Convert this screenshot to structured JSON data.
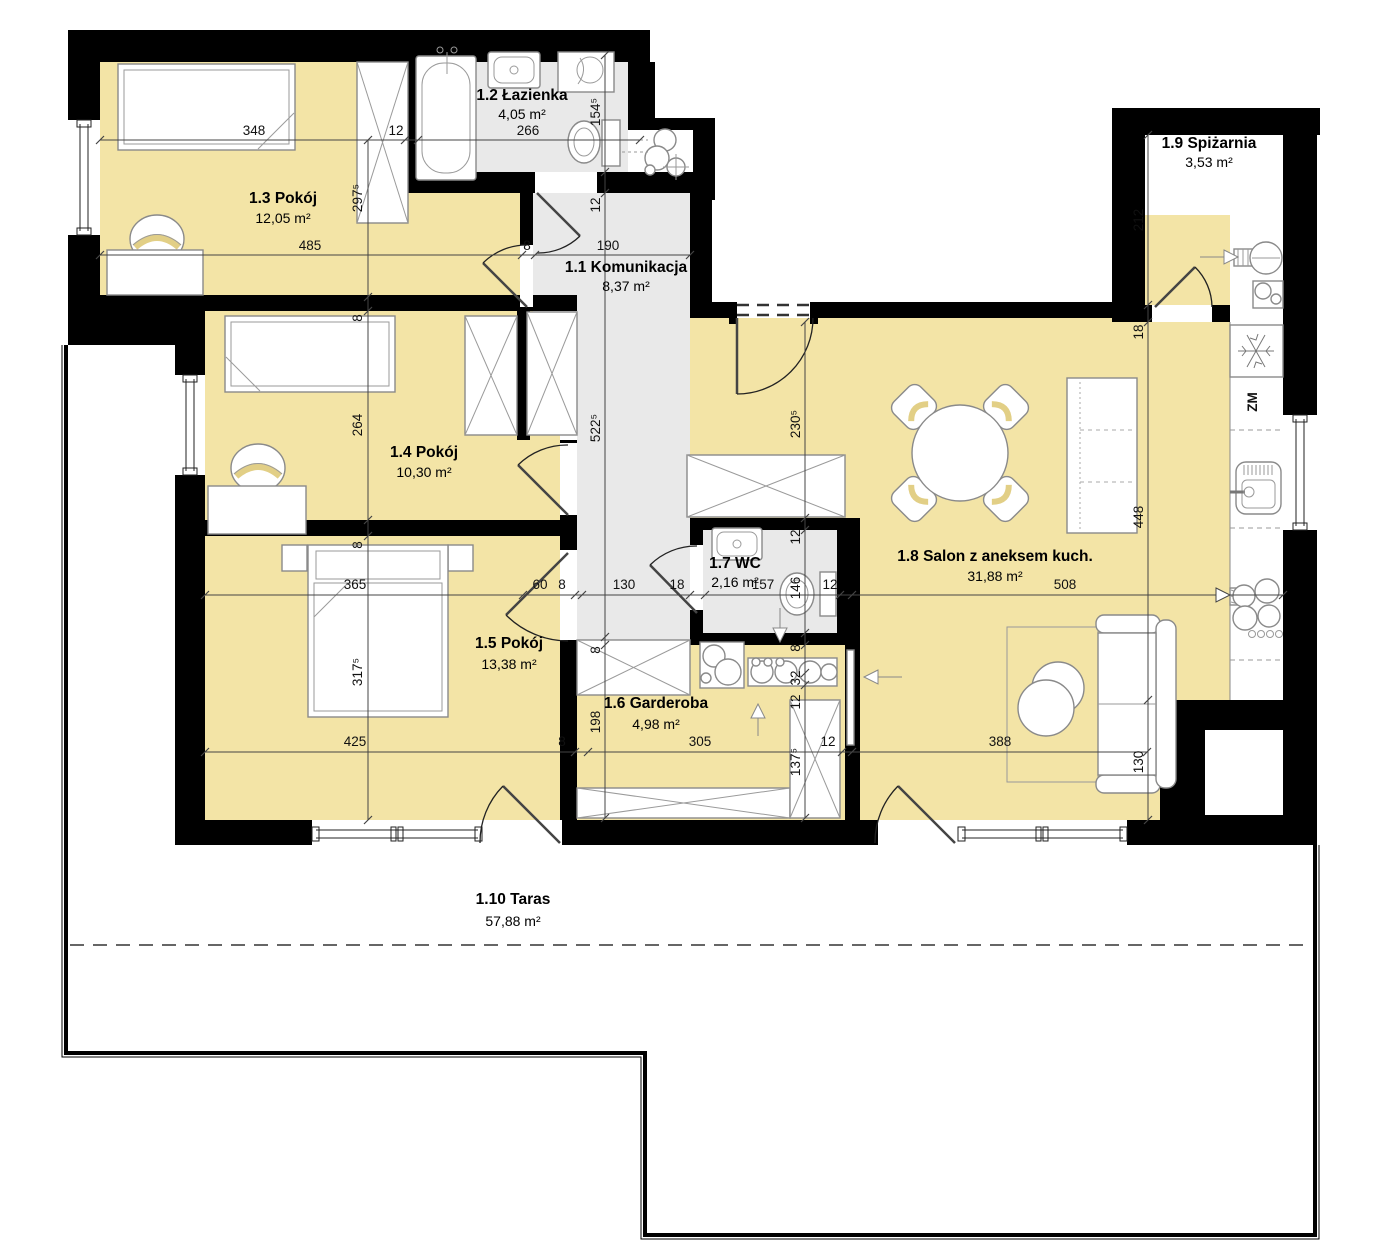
{
  "plan": {
    "type": "apartment-floor-plan",
    "rooms": [
      {
        "id": "1.1",
        "name": "1.1 Komunikacja",
        "area": "8,37 m²"
      },
      {
        "id": "1.2",
        "name": "1.2 Łazienka",
        "area": "4,05 m²"
      },
      {
        "id": "1.3",
        "name": "1.3 Pokój",
        "area": "12,05 m²"
      },
      {
        "id": "1.4",
        "name": "1.4 Pokój",
        "area": "10,30 m²"
      },
      {
        "id": "1.5",
        "name": "1.5 Pokój",
        "area": "13,38 m²"
      },
      {
        "id": "1.6",
        "name": "1.6 Garderoba",
        "area": "4,98 m²"
      },
      {
        "id": "1.7",
        "name": "1.7 WC",
        "area": "2,16 m²"
      },
      {
        "id": "1.8",
        "name": "1.8 Salon z aneksem kuch.",
        "area": "31,88 m²"
      },
      {
        "id": "1.9",
        "name": "1.9 Spiżarnia",
        "area": "3,53 m²"
      },
      {
        "id": "1.10",
        "name": "1.10 Taras",
        "area": "57,88 m²"
      }
    ],
    "dims": {
      "top": [
        "348",
        "12",
        "266"
      ],
      "upper": [
        "485",
        "8",
        "190"
      ],
      "mid": [
        "365",
        "60",
        "8",
        "130",
        "18",
        "157",
        "12",
        "508"
      ],
      "lower": [
        "425",
        "8",
        "305",
        "12",
        "388"
      ],
      "v_left": [
        "297⁵",
        "8",
        "264",
        "8",
        "317⁵"
      ],
      "v_corridor": [
        "154⁵",
        "12",
        "522⁵",
        "8",
        "198"
      ],
      "v_wc": [
        "230⁵",
        "12",
        "146",
        "8",
        "32",
        "12",
        "137⁵"
      ],
      "v_right": [
        "212",
        "18",
        "448",
        "130"
      ]
    },
    "kitchen": {
      "dishwasher_label": "ZM"
    },
    "colors": {
      "room_floor": "#f3e4a6",
      "wet_floor": "#e9e9e9",
      "wall": "#000000",
      "dimension_line": "#444444"
    }
  }
}
